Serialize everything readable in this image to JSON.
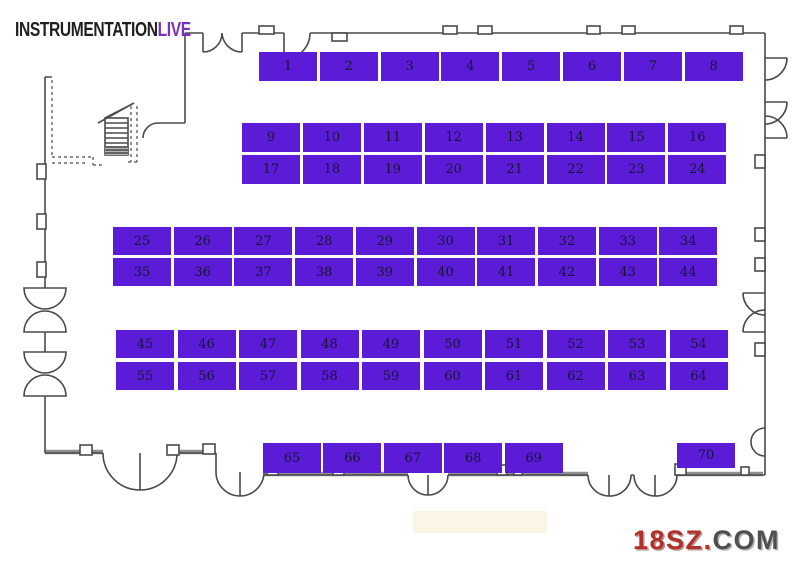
{
  "logo": {
    "text_black": "INSTRUMENTATION",
    "text_purple": "LIVE"
  },
  "watermark": {
    "text_red": "18SZ.",
    "text_gray": "COM"
  },
  "colors": {
    "booth": "#5c1cd7",
    "booth_text": "#141432",
    "wall": "#4a4a4c",
    "logo_black": "#221e20",
    "logo_purple": "#7a30c0",
    "watermark_red": "#b23029",
    "watermark_gray": "#4f4f51"
  },
  "floorplan": {
    "title": "Exhibition hall booth plan",
    "rows": [
      {
        "id": "row-1-8",
        "x": 259,
        "y": 52,
        "w": 58,
        "h": 29,
        "pitch": 60.8,
        "booths": [
          "1",
          "2",
          "3",
          "4",
          "5",
          "6",
          "7",
          "8"
        ]
      },
      {
        "id": "row-9-16",
        "x": 242,
        "y": 123,
        "w": 58,
        "h": 29,
        "pitch": 60.9,
        "booths": [
          "9",
          "10",
          "11",
          "12",
          "13",
          "14",
          "15",
          "16"
        ]
      },
      {
        "id": "row-17-24",
        "x": 242,
        "y": 155,
        "w": 58,
        "h": 29,
        "pitch": 60.9,
        "booths": [
          "17",
          "18",
          "19",
          "20",
          "21",
          "22",
          "23",
          "24"
        ]
      },
      {
        "id": "row-25-34",
        "x": 113,
        "y": 227,
        "w": 58,
        "h": 28,
        "pitch": 60.7,
        "booths": [
          "25",
          "26",
          "27",
          "28",
          "29",
          "30",
          "31",
          "32",
          "33",
          "34"
        ]
      },
      {
        "id": "row-35-44",
        "x": 113,
        "y": 258,
        "w": 58,
        "h": 28,
        "pitch": 60.7,
        "booths": [
          "35",
          "36",
          "37",
          "38",
          "39",
          "40",
          "41",
          "42",
          "43",
          "44"
        ]
      },
      {
        "id": "row-45-54",
        "x": 116,
        "y": 330,
        "w": 58,
        "h": 28,
        "pitch": 61.5,
        "booths": [
          "45",
          "46",
          "47",
          "48",
          "49",
          "50",
          "51",
          "52",
          "53",
          "54"
        ]
      },
      {
        "id": "row-55-64",
        "x": 116,
        "y": 362,
        "w": 58,
        "h": 28,
        "pitch": 61.5,
        "booths": [
          "55",
          "56",
          "57",
          "58",
          "59",
          "60",
          "61",
          "62",
          "63",
          "64"
        ]
      },
      {
        "id": "row-65-69",
        "x": 263,
        "y": 443,
        "w": 58,
        "h": 30,
        "pitch": 60.4,
        "booths": [
          "65",
          "66",
          "67",
          "68",
          "69"
        ]
      },
      {
        "id": "booth-70",
        "x": 677,
        "y": 443,
        "w": 58,
        "h": 25,
        "pitch": 0,
        "booths": [
          "70"
        ]
      }
    ]
  }
}
